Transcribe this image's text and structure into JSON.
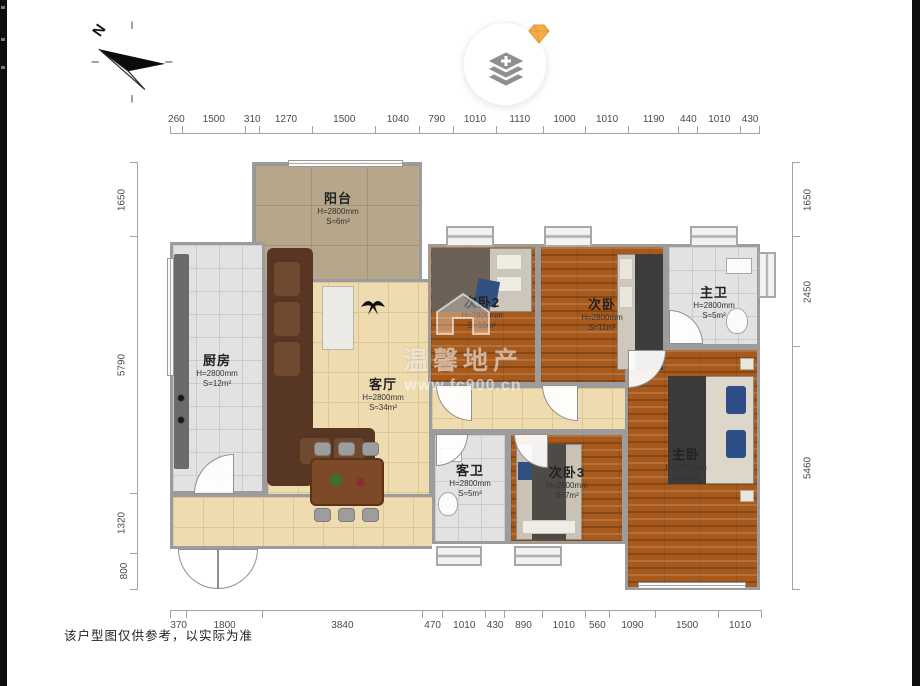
{
  "footer": {
    "disclaimer": "该户型图仅供参考，以实际为准"
  },
  "compass": {
    "label": "N"
  },
  "watermark": {
    "line1": "温馨地产",
    "line2": "www.fc900.cn"
  },
  "dims": {
    "top": [
      260,
      1500,
      310,
      1270,
      1500,
      1040,
      790,
      1010,
      1110,
      1000,
      1010,
      1190,
      440,
      1010,
      430
    ],
    "bottom": [
      370,
      1800,
      3840,
      470,
      1010,
      430,
      890,
      1010,
      560,
      1090,
      1500,
      1010
    ],
    "left": [
      1650,
      5790,
      1320,
      800
    ],
    "right": [
      1650,
      2450,
      5460
    ]
  },
  "rooms": [
    {
      "name": "阳台",
      "h": "H=2800mm",
      "s": "S≈6m²"
    },
    {
      "name": "厨房",
      "h": "H=2800mm",
      "s": "S=12m²"
    },
    {
      "name": "客厅",
      "h": "H=2800mm",
      "s": "S≈34m²"
    },
    {
      "name": "次卧2",
      "h": "H=2800mm",
      "s": "S≈10m²"
    },
    {
      "name": "次卧",
      "h": "H=2800mm",
      "s": "S≈11m²"
    },
    {
      "name": "主卫",
      "h": "H=2800mm",
      "s": "S≈5m²"
    },
    {
      "name": "客卫",
      "h": "H=2800mm",
      "s": "S≈5m²"
    },
    {
      "name": "次卧3",
      "h": "H=2800mm",
      "s": "S≈7m²"
    },
    {
      "name": "主卧",
      "h": "H=2800mm",
      "s": "S≈18m²"
    }
  ],
  "colors": {
    "wall": "#9c9c9c",
    "wood_floor": "#a85a1c",
    "tile_floor": "#e2e2e2",
    "living_floor": "#eedcb0",
    "balcony_floor": "#b6a78a",
    "sofa": "#573624",
    "accent_blue": "#31507f",
    "diamond_orange": "#f5ad49"
  }
}
